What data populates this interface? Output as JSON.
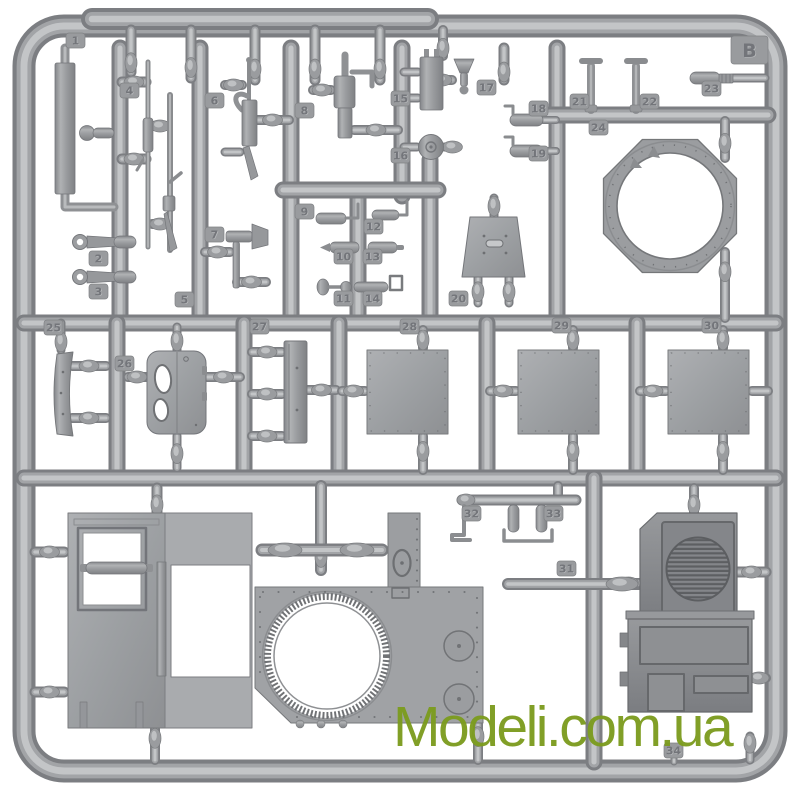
{
  "scene": {
    "description": "Photo of a gray injection-molded plastic model-kit sprue (runner frame) with numbered parts on a white background",
    "plastic_color": "#9b9da0",
    "background_color": "#ffffff"
  },
  "sprue": {
    "letter": "B",
    "letter_tab": {
      "x": 731,
      "y": 36,
      "w": 37,
      "h": 28
    },
    "part_labels": [
      {
        "num": "1",
        "x": 66,
        "y": 33
      },
      {
        "num": "2",
        "x": 89,
        "y": 251
      },
      {
        "num": "3",
        "x": 89,
        "y": 284
      },
      {
        "num": "4",
        "x": 120,
        "y": 83
      },
      {
        "num": "5",
        "x": 175,
        "y": 292
      },
      {
        "num": "6",
        "x": 205,
        "y": 93
      },
      {
        "num": "7",
        "x": 205,
        "y": 227
      },
      {
        "num": "8",
        "x": 295,
        "y": 103
      },
      {
        "num": "9",
        "x": 295,
        "y": 204
      },
      {
        "num": "10",
        "x": 334,
        "y": 249
      },
      {
        "num": "11",
        "x": 334,
        "y": 291
      },
      {
        "num": "12",
        "x": 364,
        "y": 219
      },
      {
        "num": "13",
        "x": 363,
        "y": 249
      },
      {
        "num": "14",
        "x": 363,
        "y": 291
      },
      {
        "num": "15",
        "x": 391,
        "y": 91
      },
      {
        "num": "16",
        "x": 391,
        "y": 148
      },
      {
        "num": "17",
        "x": 477,
        "y": 80
      },
      {
        "num": "18",
        "x": 529,
        "y": 101
      },
      {
        "num": "19",
        "x": 529,
        "y": 146
      },
      {
        "num": "20",
        "x": 449,
        "y": 291
      },
      {
        "num": "21",
        "x": 570,
        "y": 94
      },
      {
        "num": "22",
        "x": 640,
        "y": 94
      },
      {
        "num": "23",
        "x": 702,
        "y": 81
      },
      {
        "num": "24",
        "x": 589,
        "y": 120
      },
      {
        "num": "25",
        "x": 44,
        "y": 320
      },
      {
        "num": "26",
        "x": 115,
        "y": 356
      },
      {
        "num": "27",
        "x": 250,
        "y": 319
      },
      {
        "num": "28",
        "x": 400,
        "y": 319
      },
      {
        "num": "29",
        "x": 552,
        "y": 318
      },
      {
        "num": "30",
        "x": 702,
        "y": 318
      },
      {
        "num": "31",
        "x": 557,
        "y": 561
      },
      {
        "num": "32",
        "x": 462,
        "y": 506
      },
      {
        "num": "33",
        "x": 544,
        "y": 506
      },
      {
        "num": "34",
        "x": 664,
        "y": 743
      }
    ]
  },
  "watermark": {
    "text": "Modeli.com.ua",
    "color": "#7c9c1f"
  }
}
